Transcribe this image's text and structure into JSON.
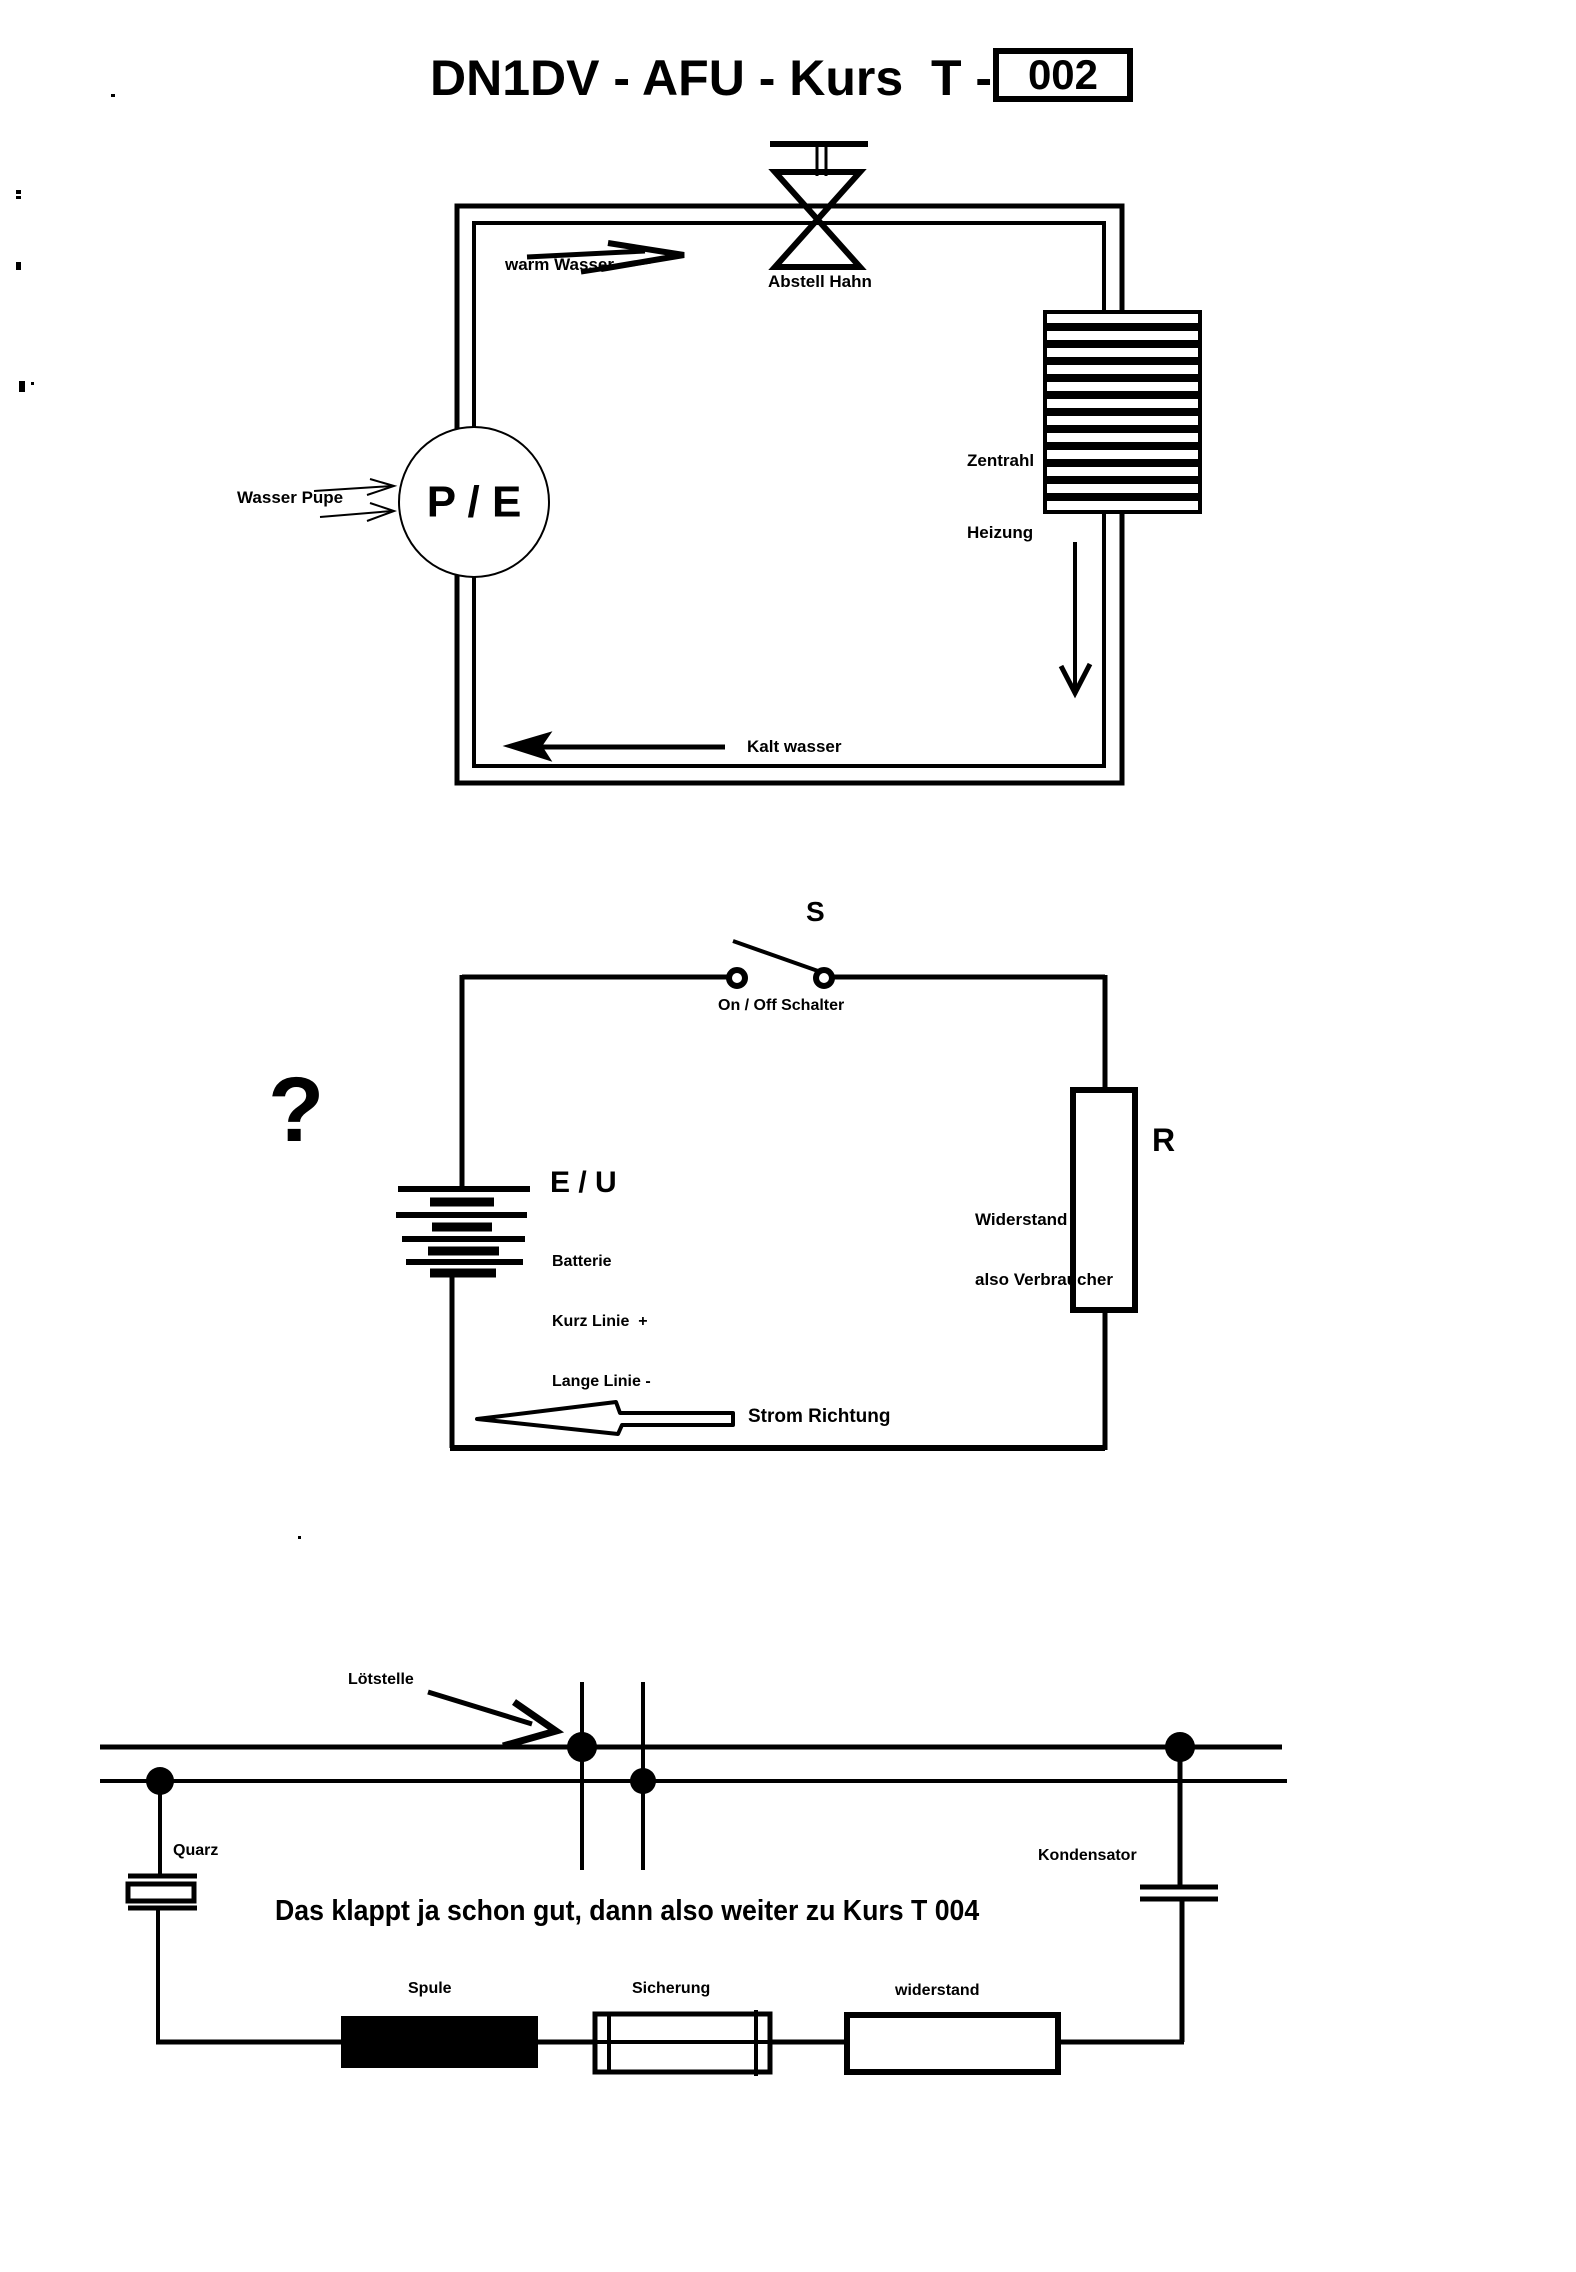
{
  "colors": {
    "ink": "#000000",
    "paper": "#ffffff"
  },
  "header": {
    "title": "DN1DV - AFU - Kurs  T -",
    "course_number": "002"
  },
  "water_circuit": {
    "warm_water_label": "warm Wasser",
    "valve_label": "Abstell Hahn",
    "heater_label_line1": "Zentrahl",
    "heater_label_line2": "Heizung",
    "pump_label": "Wasser Pupe",
    "pump_symbol": "P / E",
    "cold_water_label": "Kalt wasser"
  },
  "electric_circuit": {
    "switch_symbol": "S",
    "switch_label": "On / Off Schalter",
    "question_mark": "?",
    "source_symbol": "E / U",
    "battery_note_line1": "Batterie",
    "battery_note_line2": "Kurz Linie  +",
    "battery_note_line3": "Lange Linie -",
    "resistor_symbol": "R",
    "resistor_note_line1": "Widerstand",
    "resistor_note_line2": "also Verbraucher",
    "current_label": "Strom Richtung"
  },
  "component_diagram": {
    "solder_label": "Lötstelle",
    "crystal_label": "Quarz",
    "capacitor_label": "Kondensator",
    "coil_label": "Spule",
    "fuse_label": "Sicherung",
    "resistor_label": "widerstand",
    "message": "Das klappt ja schon gut, dann also weiter zu Kurs T 004"
  }
}
